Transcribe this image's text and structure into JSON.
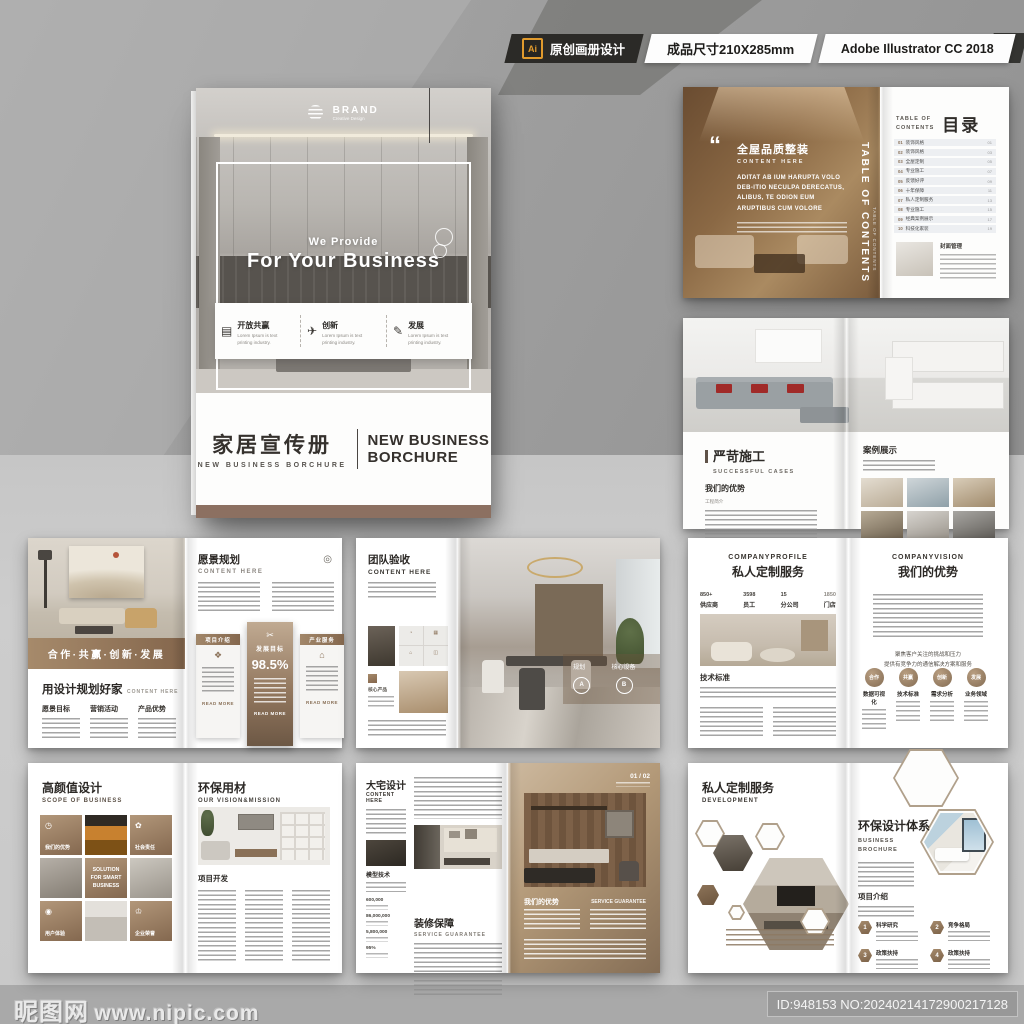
{
  "header": {
    "ai": "Ai",
    "badge1": "原创画册设计",
    "badge2": "成品尺寸210X285mm",
    "badge3": "Adobe Illustrator CC 2018"
  },
  "cover": {
    "brand": "BRAND",
    "brand_sub": "Creative Design",
    "h_small": "We Provide",
    "h_big": "For Your Business",
    "features": [
      {
        "icon": "▤",
        "title": "开放共赢",
        "desc": "Lorem Ipsum is text printing industry."
      },
      {
        "icon": "✈",
        "title": "创新",
        "desc": "Lorem Ipsum is text printing industry."
      },
      {
        "icon": "✎",
        "title": "发展",
        "desc": "Lorem Ipsum is text printing industry."
      }
    ],
    "title_cn": "家居宣传册",
    "title_cn_sub": "NEW BUSINESS BORCHURE",
    "title_en1": "NEW BUSINESS",
    "title_en2": "BORCHURE"
  },
  "toc": {
    "left": {
      "quote": "“",
      "title": "全屋品质整装",
      "subtitle": "CONTENT HERE",
      "body": "ADITAT AB IUM HARUPTA VOLO DEB-ITIO NECULPA DERECATUS, ALIBUS, TE ODION EUM ARUPTIBUS CUM VOLORE",
      "vertical": "TABLE OF CONTENTS",
      "vertical_sub": "TABLE OF CONTENTS"
    },
    "right": {
      "label1": "TABLE OF",
      "label2": "CONTENTS",
      "title": "目录",
      "items": [
        {
          "num": "01",
          "label": "装饰风格",
          "page": "01"
        },
        {
          "num": "02",
          "label": "装饰风格",
          "page": "03"
        },
        {
          "num": "03",
          "label": "全屋定制",
          "page": "05"
        },
        {
          "num": "04",
          "label": "专业施工",
          "page": "07"
        },
        {
          "num": "05",
          "label": "反馈好评",
          "page": "09"
        },
        {
          "num": "06",
          "label": "十年保障",
          "page": "11"
        },
        {
          "num": "07",
          "label": "私人定制服务",
          "page": "13"
        },
        {
          "num": "08",
          "label": "专业施工",
          "page": "15"
        },
        {
          "num": "09",
          "label": "经典案例展示",
          "page": "17"
        },
        {
          "num": "10",
          "label": "科技化家装",
          "page": "19"
        }
      ],
      "foot_title": "封面管理"
    }
  },
  "cases": {
    "left": {
      "title": "严苛施工",
      "subtitle": "SUCCESSFUL CASES",
      "sub2": "我们的优势",
      "small": "工程简介"
    },
    "right": {
      "title": "案例展示"
    }
  },
  "vision": {
    "left": {
      "banner": "合作·共赢·创新·发展",
      "title": "用设计规划好家",
      "subtitle": "CONTENT HERE",
      "cols": [
        {
          "label": "愿景目标"
        },
        {
          "label": "营销活动"
        },
        {
          "label": "产品优势"
        }
      ]
    },
    "right": {
      "title": "愿景规划",
      "subtitle": "CONTENT HERE",
      "icon": "◎",
      "read_more": "READ MORE",
      "cards": [
        {
          "label": "项目介绍",
          "icon": "❖"
        },
        {
          "label": "发展目标",
          "icon": "✂",
          "value": "98.5%"
        },
        {
          "label": "产业服务",
          "icon": "⌂"
        }
      ]
    }
  },
  "team": {
    "left": {
      "title": "团队验收",
      "subtitle": "CONTENT HERE",
      "core": "核心产品",
      "grid_icons": [
        "◔",
        "▦",
        "⌂",
        "◫"
      ]
    },
    "right": {
      "a": "规划",
      "a_badge": "A",
      "b": "核心设备",
      "b_badge": "B"
    }
  },
  "profile": {
    "left": {
      "eyebrow": "COMPANYPROFILE",
      "title": "私人定制服务",
      "stats": [
        {
          "value": "850+",
          "label": "供应商"
        },
        {
          "value": "3598",
          "label": "员工"
        },
        {
          "value": "15",
          "label": "分公司"
        },
        {
          "value": "1850",
          "label": "门店"
        }
      ],
      "section": "技术标准"
    },
    "right": {
      "eyebrow": "COMPANYVISION",
      "title": "我们的优势",
      "note1": "聚焦客户关注的挑战和压力",
      "note2": "提供有竞争力的通信解决方案和服务",
      "circles": [
        {
          "text": "合作",
          "label": "数据可视化"
        },
        {
          "text": "共赢",
          "label": "技术标准"
        },
        {
          "text": "创新",
          "label": "需求分析"
        },
        {
          "text": "发展",
          "label": "业务领域"
        }
      ]
    }
  },
  "design": {
    "left": {
      "title": "高颜值设计",
      "subtitle": "SCOPE OF BUSINESS",
      "cell1": "我们的优势",
      "cell1_icon": "◷",
      "cell2": "社会责任",
      "cell2_icon": "✿",
      "center": "SOLUTION FOR SMART BUSINESS",
      "cell3": "用户体验",
      "cell3_icon": "◉",
      "cell4": "企业荣誉",
      "cell4_icon": "♔"
    },
    "right": {
      "title": "环保用材",
      "subtitle": "OUR VISION&MISSION",
      "section": "项目开发"
    }
  },
  "mansion": {
    "left": {
      "title": "大宅设计",
      "subtitle": "CONTENT HERE",
      "photo_label": "模型技术",
      "stats": [
        {
          "value": "600,000"
        },
        {
          "value": "86,000,000"
        },
        {
          "value": "5,800,000"
        },
        {
          "value": "95%"
        }
      ],
      "section2": "装修保障",
      "section2_sub": "SERVICE GUARANTEE"
    },
    "right": {
      "page_num": "01 / 02",
      "label1": "我们的优势",
      "label2": "SERVICE GUARANTEE"
    }
  },
  "custom": {
    "left": {
      "title": "私人定制服务",
      "subtitle": "DEVELOPMENT"
    },
    "right": {
      "title": "环保设计体系",
      "sub1": "BUSINESS",
      "sub2": "BROCHURE",
      "section": "项目介绍",
      "items": [
        {
          "num": "1",
          "label": "科学研究"
        },
        {
          "num": "2",
          "label": "竞争格局"
        },
        {
          "num": "3",
          "label": "政策扶持"
        },
        {
          "num": "4",
          "label": "政策扶持"
        }
      ]
    }
  },
  "footer": {
    "site": "昵图网",
    "url": "www.nipic.com",
    "id": "ID:948153 NO:20240214172900217128"
  },
  "colors": {
    "accent_brown": "#8a7158",
    "badge_dark": "#2b2a27",
    "ai_orange": "#e09a2d"
  }
}
